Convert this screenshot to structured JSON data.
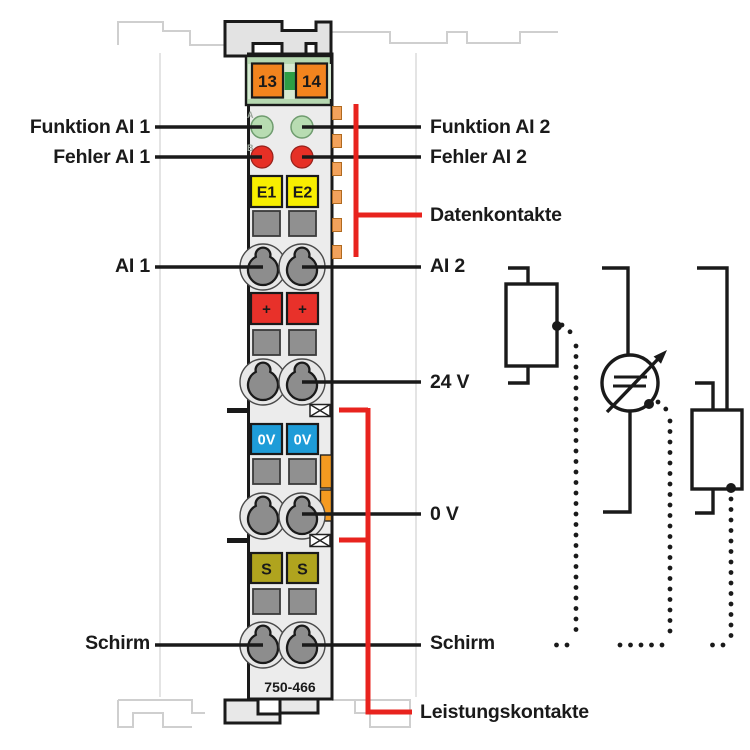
{
  "diagram": {
    "part_number": "750-466",
    "left_labels": {
      "funktion_ai1": "Funktion AI 1",
      "fehler_ai1": "Fehler AI 1",
      "ai1": "AI 1",
      "schirm": "Schirm"
    },
    "right_labels": {
      "funktion_ai2": "Funktion AI 2",
      "fehler_ai2": "Fehler AI 2",
      "datenkontakte": "Datenkontakte",
      "ai2": "AI 2",
      "v24": "24 V",
      "v0": "0 V",
      "schirm": "Schirm",
      "leistungskontakte": "Leistungskontakte"
    },
    "terminals": {
      "c13": "13",
      "c14": "14",
      "e1": "E1",
      "e2": "E2",
      "plus_left": "+",
      "plus_right": "+",
      "ov_left": "0V",
      "ov_right": "0V",
      "s_left": "S",
      "s_right": "S"
    },
    "led_markers": {
      "a": "A",
      "b": "B"
    },
    "colors": {
      "accent_red": "#e8231e",
      "led_ok_green": "#b8dcb2",
      "led_error_red": "#e63026",
      "terminal_orange": "#f2841e",
      "label_yellow": "#f8ee00",
      "label_blue": "#1e9cd8",
      "label_olive": "#b0a41e",
      "connector_green": "#b6d8b1",
      "data_contact_orange": "#f2a25c",
      "latch_orange": "#f59a20",
      "module_gray": "#ececec"
    }
  }
}
